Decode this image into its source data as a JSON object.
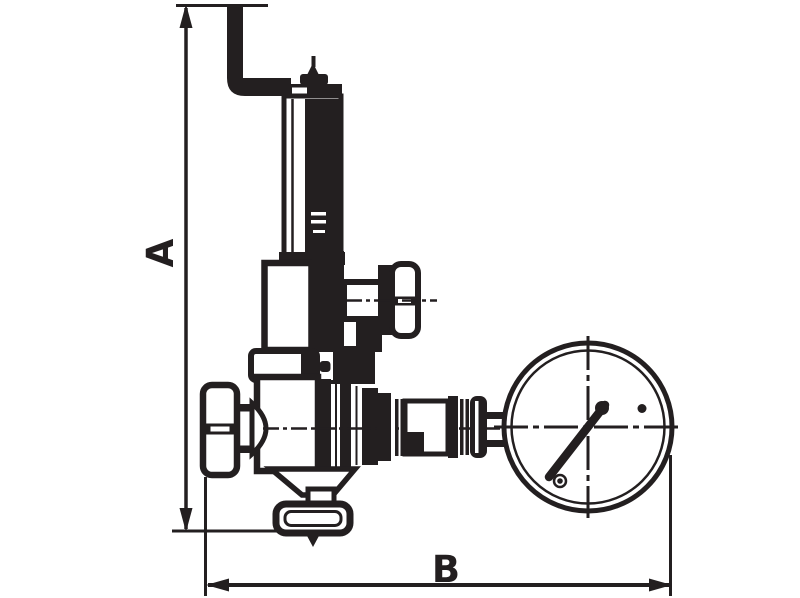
{
  "labels": {
    "vertical_dimension": "A",
    "horizontal_dimension": "B"
  },
  "colors": {
    "line": "#231f20",
    "background": "#ffffff"
  }
}
